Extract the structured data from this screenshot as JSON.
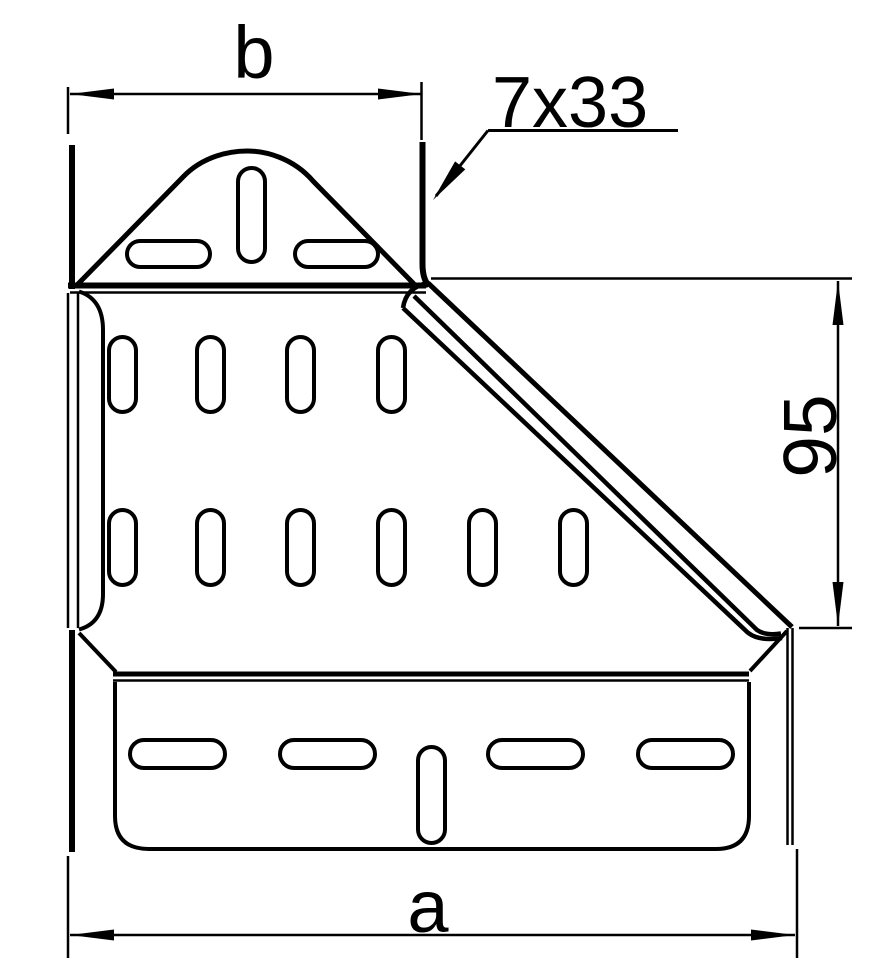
{
  "drawing": {
    "type": "technical-drawing",
    "part": "cable-tray-reducer-front-view",
    "colors": {
      "line": "#000000",
      "background": "#ffffff"
    },
    "labels": {
      "width_bottom": "a",
      "width_top": "b",
      "height_right": "95",
      "slot_callout": "7x33"
    }
  }
}
